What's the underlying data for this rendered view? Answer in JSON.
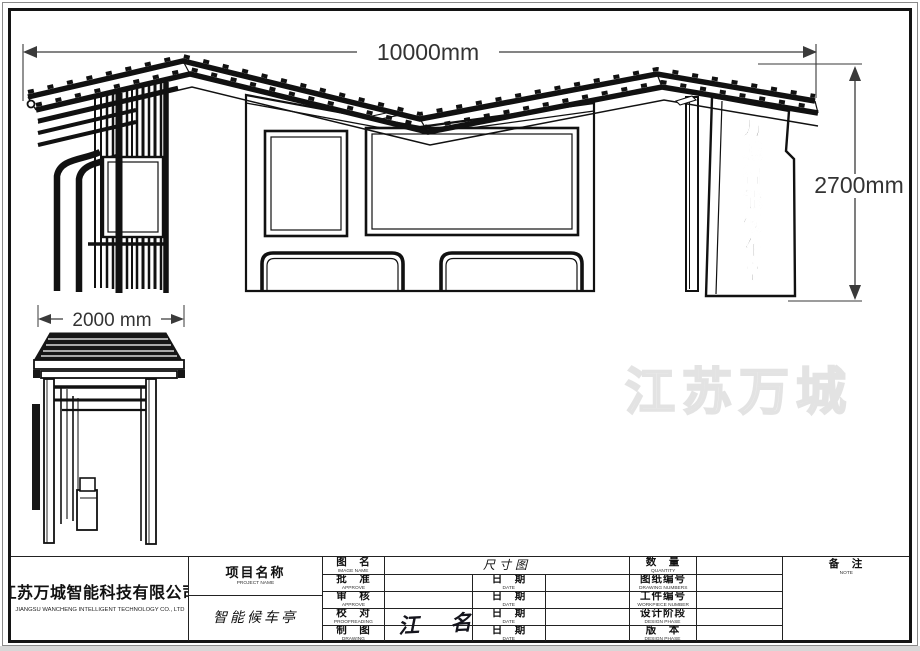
{
  "sheet": {
    "dimensions": {
      "overall_width": "10000mm",
      "overall_height": "2700mm",
      "side_depth": "2000 mm"
    },
    "totem_sign_text": "万城智能候车亭",
    "watermark": "江苏万城",
    "title_block": {
      "company_zh": "江苏万城智能科技有限公司",
      "company_en": "JIANGSU WANCHENG INTELLIGENT TECHNOLOGY CO., LTD",
      "project_label_zh": "项目名称",
      "project_label_en": "PROJECT NAME",
      "project_value": "智能候车亭",
      "drawing_name_label_zh": "图　名",
      "drawing_name_label_en": "IMAGE NAME",
      "drawing_name_value": "尺寸图",
      "rows": [
        {
          "zh": "批　准",
          "en": "APPROVE",
          "date_zh": "日　期",
          "date_en": "DATE"
        },
        {
          "zh": "审　核",
          "en": "APPROVE",
          "date_zh": "日　期",
          "date_en": "DATE"
        },
        {
          "zh": "校　对",
          "en": "PROOFREADING",
          "date_zh": "日　期",
          "date_en": "DATE"
        },
        {
          "zh": "制　图",
          "en": "DRAWING",
          "date_zh": "日　期",
          "date_en": "DATE"
        }
      ],
      "right_rows": [
        {
          "zh": "数　量",
          "en": "QUANTITY"
        },
        {
          "zh": "图纸编号",
          "en": "DRAWING NUMBERS"
        },
        {
          "zh": "工件编号",
          "en": "WORKPIECE NUMBER"
        },
        {
          "zh": "设计阶段",
          "en": "DESIGN PHASE"
        },
        {
          "zh": "版　本",
          "en": "DESIGN PHASE"
        }
      ],
      "note_zh": "备　注",
      "note_en": "NOTE",
      "signature": "江 名"
    }
  }
}
